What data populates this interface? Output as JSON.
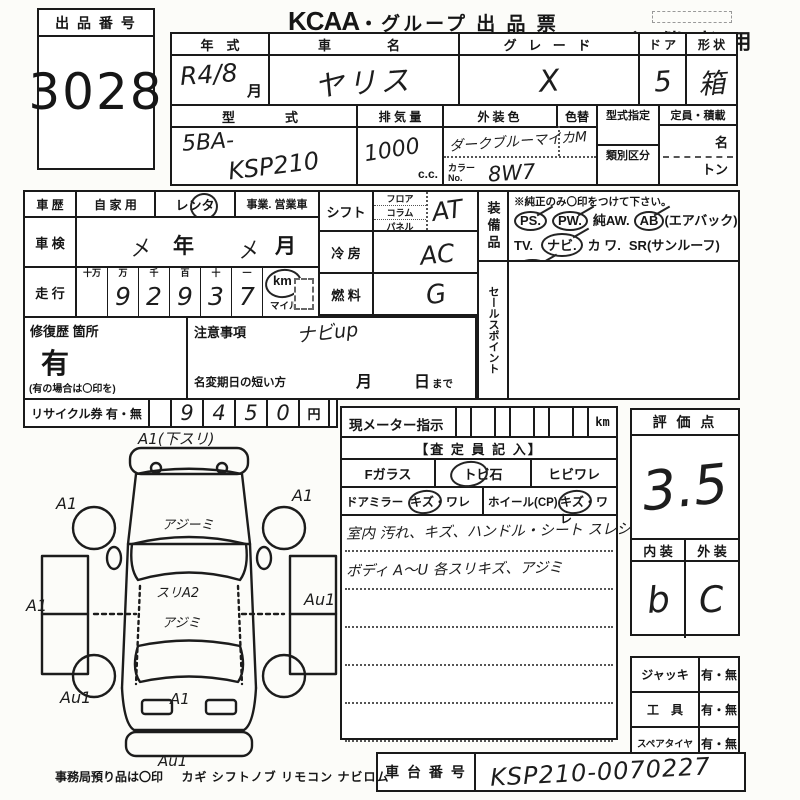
{
  "colors": {
    "paper": "#fcfcf9",
    "ink": "#1a1a1a"
  },
  "header": {
    "lot_label": "出 品 番 号",
    "lot_number": "3028",
    "brand": "KCAA",
    "title": "・グループ 出 品 票",
    "audience": "主 催 者 用"
  },
  "row1": {
    "year_label": "年　式",
    "year_value": "R4/8",
    "month_suffix": "月",
    "name_label": "車　　名",
    "name_value": "ヤリス",
    "grade_label": "グ レ ー ド",
    "grade_value": "X",
    "door_label": "ド ア",
    "door_value": "5",
    "shape_label": "形 状",
    "shape_value": "箱"
  },
  "row2": {
    "model_label": "型　　式",
    "model_prefix": "5BA-",
    "model_code": "KSP210",
    "disp_label": "排 気 量",
    "disp_value": "1000",
    "disp_unit": "c.c.",
    "color_label": "外装色",
    "color_value": "ダークブルーマイカM",
    "color_change_label": "色替",
    "color_no_label": "カラーNo.",
    "color_no_value": "8W7",
    "type_desig_label": "型式指定",
    "class_label": "類別区分",
    "capacity_label": "定員・積載",
    "capacity_persons": "名",
    "capacity_tons": "トン"
  },
  "history": {
    "label": "車 歴",
    "private": "自 家 用",
    "rental": "レンタ",
    "business": "事業. 営業車"
  },
  "inspection": {
    "label": "車 検",
    "x1": "メ",
    "year": "年",
    "x2": "メ",
    "month": "月"
  },
  "mileage": {
    "label": "走 行",
    "columns": [
      "十万",
      "万",
      "千",
      "百",
      "十",
      "一"
    ],
    "digits": [
      "",
      "9",
      "2",
      "9",
      "3",
      "7"
    ],
    "km": "km",
    "mile": "マイル"
  },
  "repair": {
    "label": "修復歴 箇所",
    "value": "有",
    "note": "(有の場合は〇印を)"
  },
  "caution": {
    "label": "注意事項",
    "value": "ナビup",
    "rename_label": "名変期日の短い方",
    "month": "月",
    "day": "日",
    "made": "まで"
  },
  "recycle": {
    "label": "リサイクル券 有・無",
    "digits": [
      "9",
      "4",
      "5",
      "0"
    ],
    "unit": "円"
  },
  "spec": {
    "shift_label": "シフト",
    "shift_options": [
      "フロア",
      "コラム",
      "パネル"
    ],
    "shift_value": "AT",
    "cool_label": "冷 房",
    "cool_value": "AC",
    "fuel_label": "燃 料",
    "fuel_value": "G"
  },
  "equipment": {
    "side_label": "装備品",
    "note": "※純正のみ〇印をつけて下さい。",
    "ps": "PS.",
    "pw": "PW.",
    "aw": "純AW.",
    "ab": "AB",
    "ab_suffix": "(エアバック)",
    "tv": "TV.",
    "navi": "ナビ.",
    "kawa": "カ ワ.",
    "sr": "SR(サンルーフ)",
    "abs": "ABS",
    "dot": "・",
    "warranty": "新車保証書←(注) 後日送りのみ",
    "sales_label": "セールスポイント"
  },
  "meter": {
    "label": "現メーター指示",
    "unit": "km",
    "assessor": "【査 定 員 記 入】",
    "f_glass": "Fガラス",
    "stone": "トビ石",
    "crack": "ヒビワレ",
    "mirror": "ドアミラー",
    "mirror_dmg": "キズ・ワレ",
    "wheel": "ホイール(CP)",
    "wheel_dmg": "キズ・ワレ",
    "note1": "室内 汚れ、キズ、ハンドル・シート スレシミ",
    "note2": "ボディ A〜U 各スリキズ、アジミ"
  },
  "evaluation": {
    "label": "評 価 点",
    "score": "3.5",
    "interior_label": "内 装",
    "exterior_label": "外 装",
    "interior": "b",
    "exterior": "C"
  },
  "accessories": {
    "jack": "ジャッキ",
    "tool": "工　具",
    "spare": "スペアタイヤ",
    "umu": "有・無"
  },
  "chassis": {
    "label": "車 台 番 号",
    "value": "KSP210-0070227"
  },
  "footer": {
    "office": "事務局預り品は〇印",
    "items": "カギ シフトノブ リモコン ナビロム"
  },
  "diagram": {
    "top": "A1(下スリ)",
    "left_top": "A1",
    "right_top": "A1",
    "left_mid": "A1",
    "right_mid": "Au1",
    "left_bottom": "Au1",
    "bottom_center": "A1",
    "bottom": "Au1",
    "hood": "アジーミ",
    "roof_a": "スリA2",
    "roof_b": "アジミ"
  }
}
